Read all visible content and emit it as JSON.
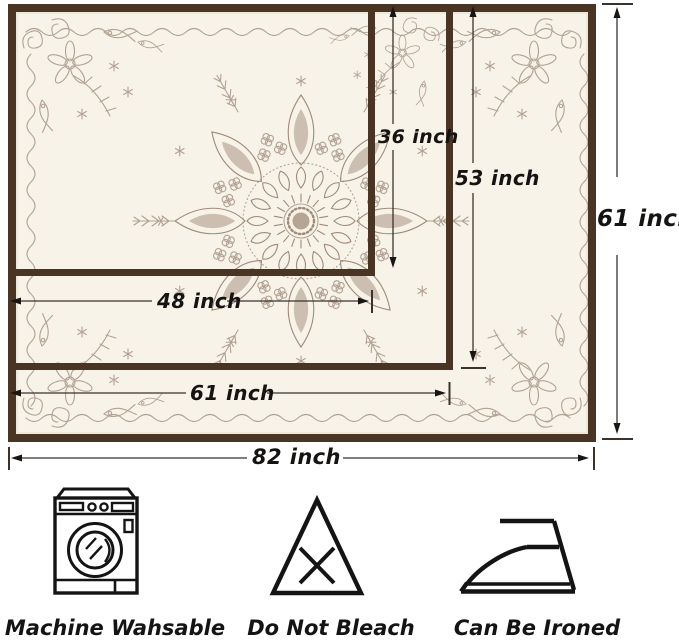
{
  "tablecloths": [
    {
      "name": "small",
      "width": "48 inch",
      "height": "36 inch"
    },
    {
      "name": "medium",
      "width": "61 inch",
      "height": "53 inch"
    },
    {
      "name": "large",
      "width": "82 inch",
      "height": "61 inch"
    }
  ],
  "care_instructions": [
    {
      "icon": "washing-machine-icon",
      "label": "Machine Wahsable"
    },
    {
      "icon": "do-not-bleach-icon",
      "label": "Do Not Bleach"
    },
    {
      "icon": "iron-icon",
      "label": "Can Be Ironed"
    }
  ],
  "colors": {
    "fabric": "#f8f3e8",
    "cloth_border": "#4a3424",
    "pattern": "#b2a294",
    "pattern_dark": "#a08a79",
    "dimension_line": "#3a332c",
    "text": "#161412"
  }
}
